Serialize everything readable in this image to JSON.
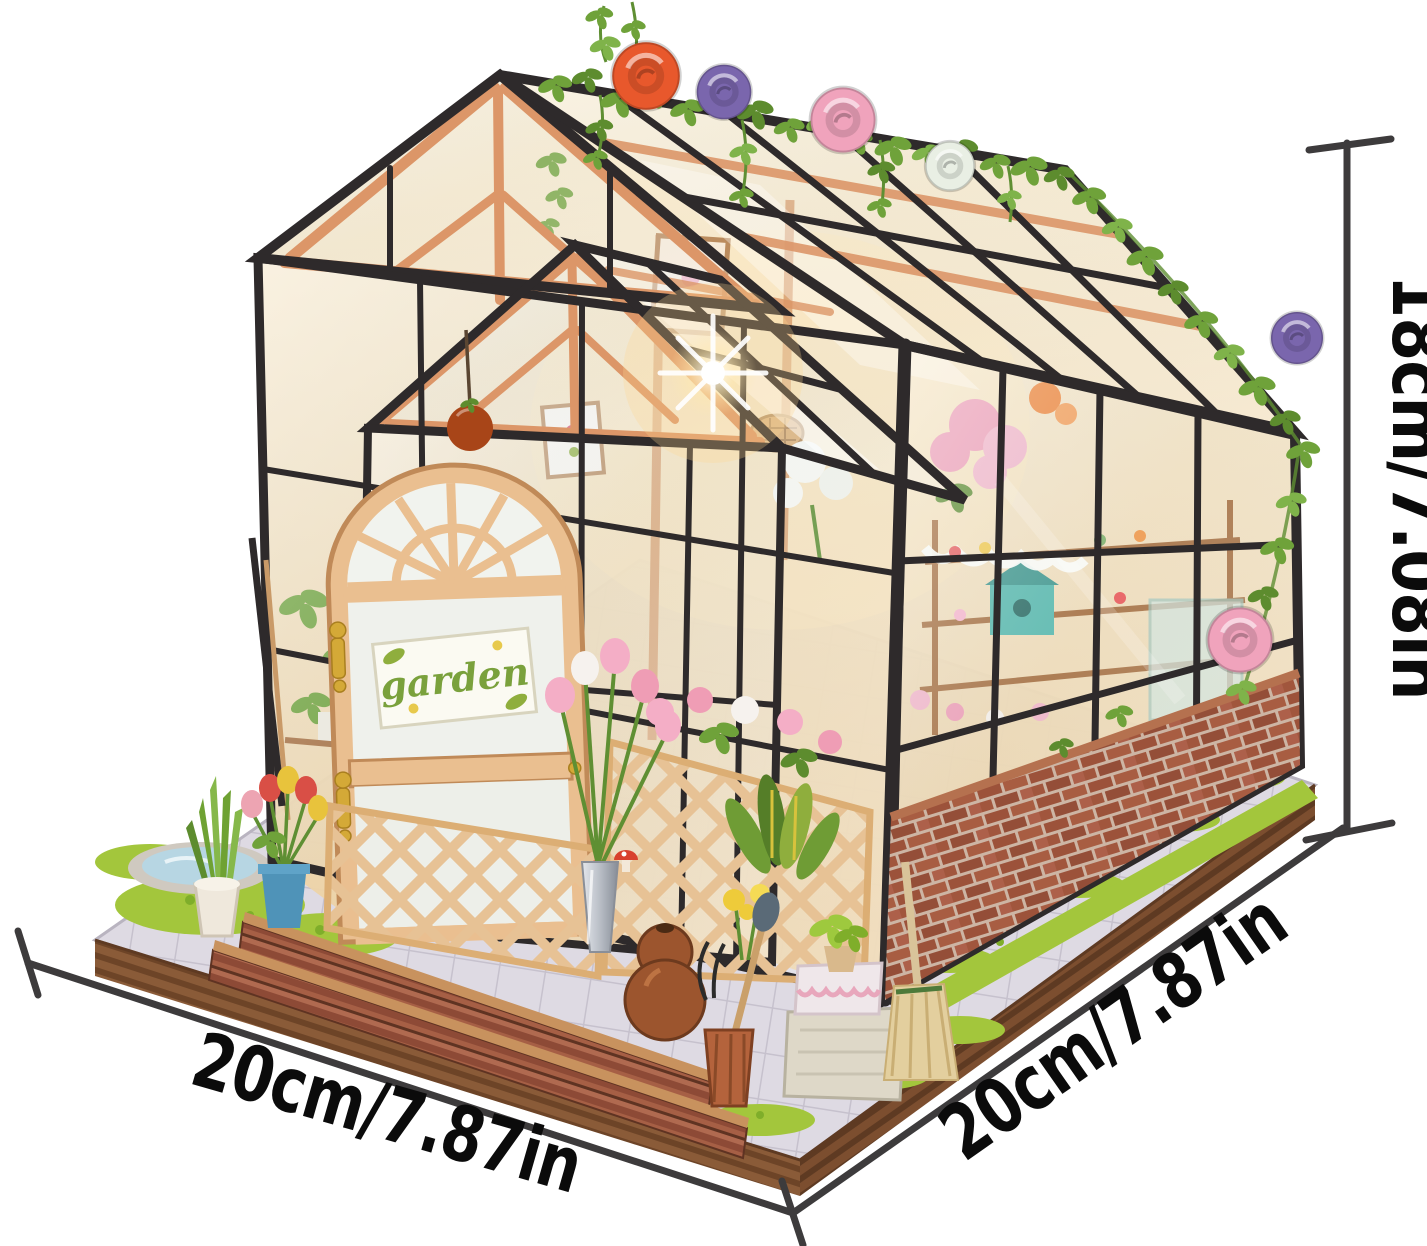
{
  "scene": {
    "type": "product-photo",
    "subject": "DIY miniature greenhouse flower-house kit with printed size annotations",
    "background_color": "#ffffff"
  },
  "dimensions": {
    "height_label": "18cm/7.08in",
    "width_label": "20cm/7.87in",
    "depth_label": "20cm/7.87in",
    "line_color": "#3d3b3c",
    "text_color": "#0b0b0b"
  },
  "door_sign": {
    "text": "garden",
    "text_color": "#7aa13c",
    "background": "#fbfaf2"
  },
  "palette": {
    "frame_black": "#2e2a2b",
    "wood_orange": "#dc9668",
    "door_wood": "#eabf90",
    "interior_warm": "#f6e6c2",
    "glass_tint": "#dfe9ef",
    "grass_green": "#a3c63c",
    "brick_red": "#9c523a",
    "paving_gray": "#dedae3",
    "base_wood": "#8a5b38",
    "vine_green": "#6fa23a"
  },
  "roses": {
    "orange": "#e8582c",
    "purple": "#7a66ad",
    "pink": "#f0a3bc",
    "white": "#e9efe4"
  }
}
